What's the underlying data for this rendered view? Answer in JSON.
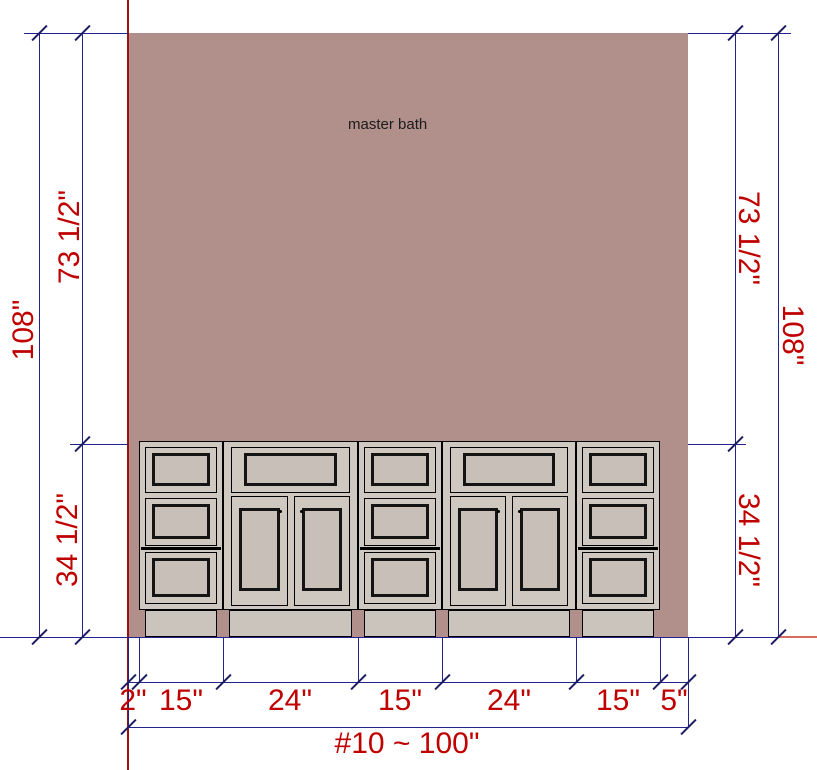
{
  "drawing": {
    "room_label": "master bath",
    "dimensions": {
      "left_total": "108\"",
      "left_upper": "73 1/2\"",
      "left_lower": "34 1/2\"",
      "right_upper": "73 1/2\"",
      "right_total": "108\"",
      "right_lower": "34 1/2\"",
      "bottom_segments": [
        "2\"",
        "15\"",
        "24\"",
        "15\"",
        "24\"",
        "15\"",
        "5\""
      ],
      "bottom_total": "#10 ~ 100\""
    },
    "cabinets": [
      {
        "width": "15\"",
        "type": "three-drawer base"
      },
      {
        "width": "24\"",
        "type": "drawer over double doors"
      },
      {
        "width": "15\"",
        "type": "three-drawer base"
      },
      {
        "width": "24\"",
        "type": "drawer over double doors"
      },
      {
        "width": "15\"",
        "type": "three-drawer base"
      }
    ],
    "fillers": {
      "left": "2\"",
      "right": "5\""
    },
    "colors": {
      "wall": "#b18f8b",
      "cabinet_face": "#cfc8c0",
      "cabinet_panel": "#c8c0b8",
      "dimension_line": "#23238f",
      "dimension_text": "#c00000",
      "reference_line": "#9b1010"
    }
  }
}
